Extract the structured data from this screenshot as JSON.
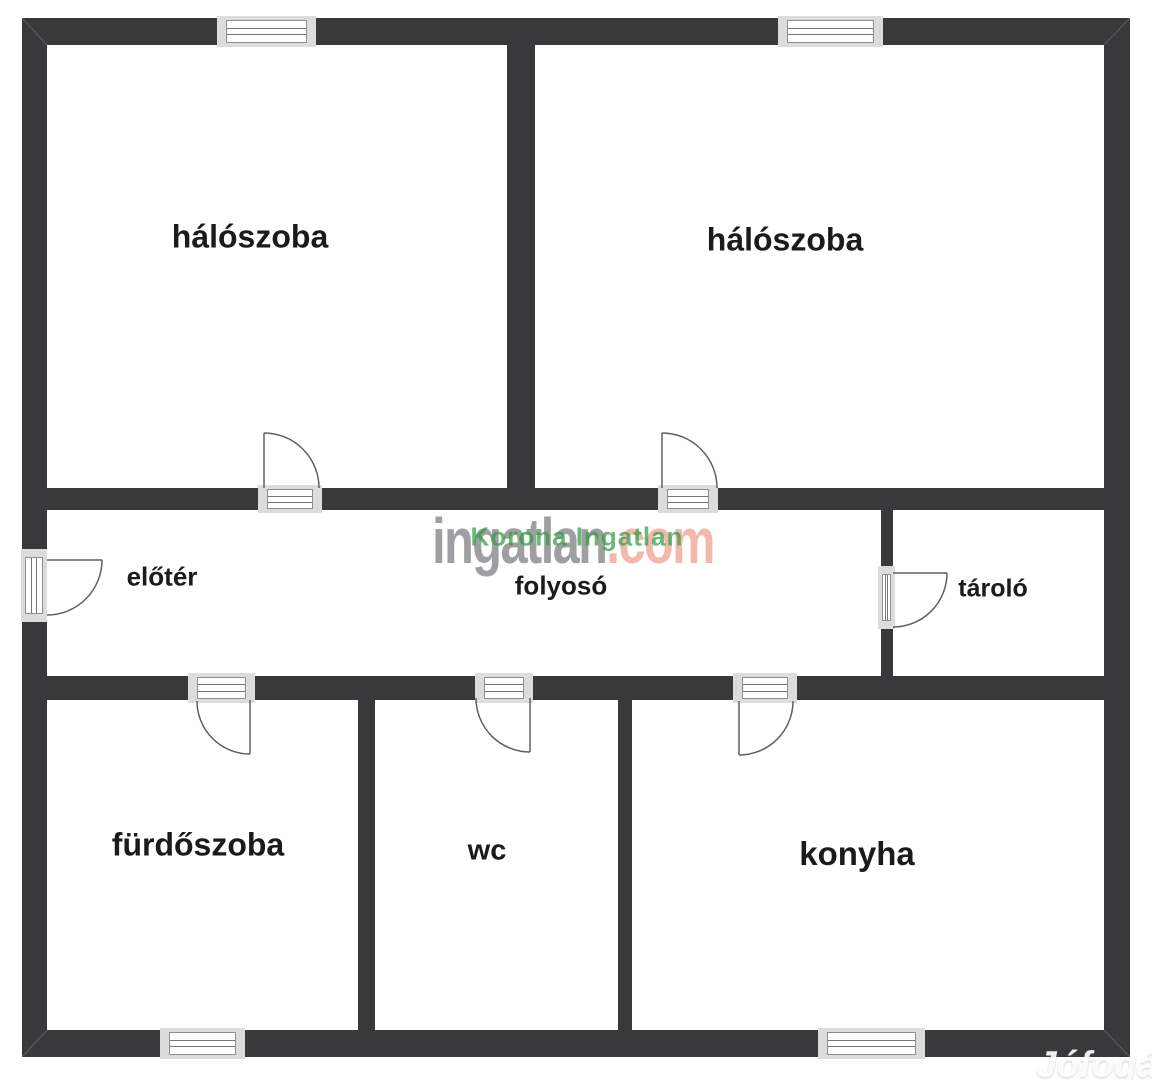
{
  "plan": {
    "rooms": [
      {
        "id": "haloszoba-1",
        "label": "hálószoba"
      },
      {
        "id": "haloszoba-2",
        "label": "hálószoba"
      },
      {
        "id": "eloter",
        "label": "előtér"
      },
      {
        "id": "folyoso",
        "label": "folyosó"
      },
      {
        "id": "tarolo",
        "label": "tároló"
      },
      {
        "id": "furdoszoba",
        "label": "fürdőszoba"
      },
      {
        "id": "wc",
        "label": "wc"
      },
      {
        "id": "konyha",
        "label": "konyha"
      }
    ]
  },
  "watermarks": {
    "center_brand_gray": "ingatlan",
    "center_brand_accent": ".com",
    "center_overlay": "Korona Ingatlan",
    "corner_brand": "Jófogás"
  },
  "colors": {
    "wall": "#39383b",
    "brand_gray": "#97969b",
    "brand_accent": "#f2b3a4",
    "overlay_green": "#2f9e41",
    "label_text": "#1b1b1d"
  }
}
